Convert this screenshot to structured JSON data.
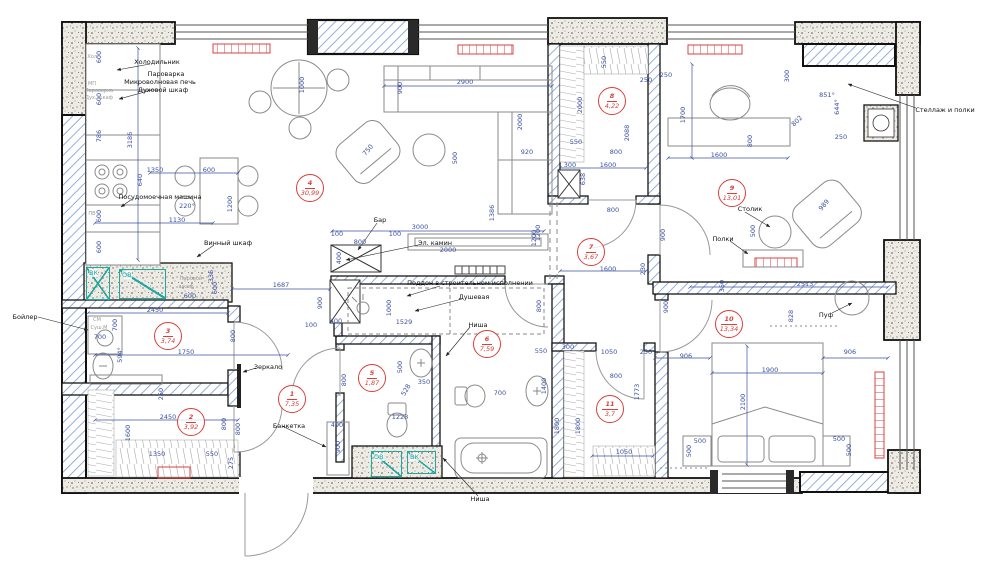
{
  "colors": {
    "dimension": "#3a50a0",
    "room_badge": "#d8403b",
    "wall": "#111111",
    "hatch": "#88a6d6",
    "shaft": "#1fa7a0",
    "radiator": "#d94040",
    "annotation": "#111111"
  },
  "rooms": [
    {
      "number": "1",
      "area": "7,35",
      "x": 291,
      "y": 398
    },
    {
      "number": "2",
      "area": "3,92",
      "x": 190,
      "y": 421
    },
    {
      "number": "3",
      "area": "3,74",
      "x": 167,
      "y": 335
    },
    {
      "number": "4",
      "area": "30,99",
      "x": 309,
      "y": 187
    },
    {
      "number": "5",
      "area": "1,87",
      "x": 371,
      "y": 377
    },
    {
      "number": "6",
      "area": "7,59",
      "x": 486,
      "y": 343
    },
    {
      "number": "7",
      "area": "3,67",
      "x": 590,
      "y": 251
    },
    {
      "number": "8",
      "area": "4,22",
      "x": 611,
      "y": 100
    },
    {
      "number": "9",
      "area": "13,01",
      "x": 731,
      "y": 192
    },
    {
      "number": "10",
      "area": "13,34",
      "x": 728,
      "y": 323
    },
    {
      "number": "11",
      "area": "3,7",
      "x": 609,
      "y": 408
    }
  ],
  "annotations": [
    {
      "t": "Холодильник",
      "x": 157,
      "y": 62
    },
    {
      "t": "Пароварка",
      "x": 166,
      "y": 74
    },
    {
      "t": "Микроволновая печь",
      "x": 160,
      "y": 82
    },
    {
      "t": "Духовой шкаф",
      "x": 163,
      "y": 90
    },
    {
      "t": "Посудомоечная машина",
      "x": 160,
      "y": 197
    },
    {
      "t": "Винный шкаф",
      "x": 228,
      "y": 243
    },
    {
      "t": "Бар",
      "x": 380,
      "y": 220
    },
    {
      "t": "Эл. камин",
      "x": 435,
      "y": 243
    },
    {
      "t": "Поддон в строительном исполнении",
      "x": 470,
      "y": 283
    },
    {
      "t": "Душевая",
      "x": 474,
      "y": 297
    },
    {
      "t": "Ниша",
      "x": 478,
      "y": 325
    },
    {
      "t": "Зеркало",
      "x": 268,
      "y": 367
    },
    {
      "t": "Банкетка",
      "x": 289,
      "y": 426
    },
    {
      "t": "Бойлер",
      "x": 25,
      "y": 317
    },
    {
      "t": "Стеллаж и полки",
      "x": 945,
      "y": 110
    },
    {
      "t": "Столик",
      "x": 750,
      "y": 209
    },
    {
      "t": "Полки",
      "x": 723,
      "y": 239
    },
    {
      "t": "Пуф",
      "x": 826,
      "y": 315
    },
    {
      "t": "Ниша",
      "x": 480,
      "y": 499
    }
  ],
  "equipment_labels": [
    {
      "t": "Хол.",
      "x": 93,
      "y": 57
    },
    {
      "t": "МП",
      "x": 92,
      "y": 84
    },
    {
      "t": "Пароварка",
      "x": 99,
      "y": 91
    },
    {
      "t": "Дух. шкаф",
      "x": 99,
      "y": 98
    },
    {
      "t": "ПВ",
      "x": 92,
      "y": 214
    },
    {
      "t": "СМ",
      "x": 97,
      "y": 320
    },
    {
      "t": "Суш.М",
      "x": 99,
      "y": 328
    },
    {
      "t": "Паровой",
      "x": 191,
      "y": 279
    },
    {
      "t": "шкаф",
      "x": 186,
      "y": 287
    }
  ],
  "shafts": [
    {
      "label": "ВК",
      "x": 86,
      "y": 267,
      "w": 24,
      "h": 33,
      "cross": true
    },
    {
      "label": "ОВ",
      "x": 119,
      "y": 269,
      "w": 47,
      "h": 30,
      "cross": false
    },
    {
      "label": "ОВ",
      "x": 371,
      "y": 451,
      "w": 31,
      "h": 26,
      "cross": false
    },
    {
      "label": "ВК",
      "x": 407,
      "y": 451,
      "w": 29,
      "h": 23,
      "cross": false
    }
  ],
  "dimensions": [
    {
      "t": "600",
      "x": 99,
      "y": 57,
      "v": 1
    },
    {
      "t": "600",
      "x": 99,
      "y": 99,
      "v": 1
    },
    {
      "t": "786",
      "x": 99,
      "y": 136,
      "v": 1
    },
    {
      "t": "3186",
      "x": 130,
      "y": 140,
      "v": 1
    },
    {
      "t": "640",
      "x": 140,
      "y": 180,
      "v": 1
    },
    {
      "t": "600",
      "x": 99,
      "y": 216,
      "v": 1
    },
    {
      "t": "600",
      "x": 99,
      "y": 247,
      "v": 1
    },
    {
      "t": "1350",
      "x": 155,
      "y": 170
    },
    {
      "t": "600",
      "x": 209,
      "y": 170
    },
    {
      "t": "1200",
      "x": 230,
      "y": 204,
      "v": 1
    },
    {
      "t": "220°",
      "x": 187,
      "y": 206
    },
    {
      "t": "1130",
      "x": 177,
      "y": 220
    },
    {
      "t": "1000",
      "x": 302,
      "y": 85,
      "v": 1
    },
    {
      "t": "2900",
      "x": 465,
      "y": 82
    },
    {
      "t": "900",
      "x": 400,
      "y": 88,
      "v": 1
    },
    {
      "t": "2000",
      "x": 520,
      "y": 122,
      "v": 1
    },
    {
      "t": "920",
      "x": 527,
      "y": 152
    },
    {
      "t": "500",
      "x": 455,
      "y": 158,
      "v": 1
    },
    {
      "t": "750",
      "x": 368,
      "y": 150,
      "r": -50
    },
    {
      "t": "3000",
      "x": 420,
      "y": 227
    },
    {
      "t": "100",
      "x": 337,
      "y": 234
    },
    {
      "t": "800",
      "x": 360,
      "y": 242
    },
    {
      "t": "100",
      "x": 395,
      "y": 234
    },
    {
      "t": "400",
      "x": 339,
      "y": 258,
      "v": 1
    },
    {
      "t": "2000",
      "x": 448,
      "y": 250
    },
    {
      "t": "1386",
      "x": 492,
      "y": 213,
      "v": 1
    },
    {
      "t": "1200",
      "x": 538,
      "y": 233,
      "v": 1
    },
    {
      "t": "900",
      "x": 320,
      "y": 303,
      "v": 1
    },
    {
      "t": "400",
      "x": 336,
      "y": 321
    },
    {
      "t": "100",
      "x": 311,
      "y": 325
    },
    {
      "t": "1000",
      "x": 389,
      "y": 308,
      "v": 1
    },
    {
      "t": "1529",
      "x": 404,
      "y": 322
    },
    {
      "t": "1687",
      "x": 281,
      "y": 285
    },
    {
      "t": "336",
      "x": 211,
      "y": 276,
      "v": 1
    },
    {
      "t": "600",
      "x": 215,
      "y": 288,
      "v": 1
    },
    {
      "t": "600",
      "x": 190,
      "y": 296
    },
    {
      "t": "2450",
      "x": 155,
      "y": 310
    },
    {
      "t": "700",
      "x": 115,
      "y": 325,
      "v": 1
    },
    {
      "t": "700",
      "x": 100,
      "y": 337
    },
    {
      "t": "800",
      "x": 233,
      "y": 336,
      "v": 1
    },
    {
      "t": "1750",
      "x": 186,
      "y": 352
    },
    {
      "t": "594°",
      "x": 120,
      "y": 355,
      "v": 1
    },
    {
      "t": "250",
      "x": 161,
      "y": 394,
      "v": 1
    },
    {
      "t": "2450",
      "x": 168,
      "y": 417
    },
    {
      "t": "800",
      "x": 224,
      "y": 424,
      "v": 1
    },
    {
      "t": "1600",
      "x": 128,
      "y": 433,
      "v": 1
    },
    {
      "t": "1350",
      "x": 157,
      "y": 454
    },
    {
      "t": "550",
      "x": 212,
      "y": 454
    },
    {
      "t": "800",
      "x": 238,
      "y": 429,
      "v": 1
    },
    {
      "t": "275",
      "x": 231,
      "y": 463,
      "v": 1
    },
    {
      "t": "400",
      "x": 337,
      "y": 425
    },
    {
      "t": "900",
      "x": 338,
      "y": 447,
      "v": 1
    },
    {
      "t": "800",
      "x": 344,
      "y": 380,
      "v": 1
    },
    {
      "t": "500",
      "x": 400,
      "y": 367,
      "v": 1
    },
    {
      "t": "350",
      "x": 424,
      "y": 382
    },
    {
      "t": "528",
      "x": 406,
      "y": 390,
      "r": -60
    },
    {
      "t": "1228",
      "x": 400,
      "y": 417
    },
    {
      "t": "550",
      "x": 541,
      "y": 351
    },
    {
      "t": "300",
      "x": 568,
      "y": 347
    },
    {
      "t": "700",
      "x": 500,
      "y": 393
    },
    {
      "t": "1400",
      "x": 544,
      "y": 386,
      "v": 1
    },
    {
      "t": "1800",
      "x": 557,
      "y": 426,
      "v": 1
    },
    {
      "t": "1600",
      "x": 608,
      "y": 269
    },
    {
      "t": "230",
      "x": 643,
      "y": 269,
      "v": 1
    },
    {
      "t": "800",
      "x": 613,
      "y": 210
    },
    {
      "t": "1200",
      "x": 534,
      "y": 238,
      "v": 1
    },
    {
      "t": "900",
      "x": 663,
      "y": 235,
      "v": 1
    },
    {
      "t": "900",
      "x": 666,
      "y": 307,
      "v": 1
    },
    {
      "t": "800",
      "x": 539,
      "y": 306,
      "v": 1
    },
    {
      "t": "550",
      "x": 604,
      "y": 62,
      "v": 1
    },
    {
      "t": "2000",
      "x": 580,
      "y": 105,
      "v": 1
    },
    {
      "t": "250",
      "x": 646,
      "y": 80
    },
    {
      "t": "250",
      "x": 666,
      "y": 75
    },
    {
      "t": "2088",
      "x": 627,
      "y": 133,
      "v": 1
    },
    {
      "t": "800",
      "x": 616,
      "y": 152
    },
    {
      "t": "1600",
      "x": 608,
      "y": 165
    },
    {
      "t": "638",
      "x": 583,
      "y": 179,
      "v": 1
    },
    {
      "t": "300",
      "x": 570,
      "y": 165
    },
    {
      "t": "550",
      "x": 576,
      "y": 142
    },
    {
      "t": "1700",
      "x": 683,
      "y": 115,
      "v": 1
    },
    {
      "t": "1600",
      "x": 719,
      "y": 155
    },
    {
      "t": "800",
      "x": 750,
      "y": 141,
      "v": 1
    },
    {
      "t": "500",
      "x": 753,
      "y": 231,
      "v": 1
    },
    {
      "t": "350",
      "x": 722,
      "y": 286,
      "v": 1
    },
    {
      "t": "2513",
      "x": 805,
      "y": 284
    },
    {
      "t": "828",
      "x": 791,
      "y": 316,
      "v": 1
    },
    {
      "t": "906",
      "x": 686,
      "y": 356
    },
    {
      "t": "906",
      "x": 850,
      "y": 352
    },
    {
      "t": "1900",
      "x": 770,
      "y": 370
    },
    {
      "t": "2100",
      "x": 743,
      "y": 402,
      "v": 1
    },
    {
      "t": "500",
      "x": 700,
      "y": 441
    },
    {
      "t": "500",
      "x": 689,
      "y": 451,
      "v": 1
    },
    {
      "t": "500",
      "x": 839,
      "y": 439
    },
    {
      "t": "500",
      "x": 849,
      "y": 450,
      "v": 1
    },
    {
      "t": "1050",
      "x": 609,
      "y": 352
    },
    {
      "t": "250",
      "x": 646,
      "y": 352
    },
    {
      "t": "800",
      "x": 616,
      "y": 376
    },
    {
      "t": "1773",
      "x": 637,
      "y": 392,
      "v": 1
    },
    {
      "t": "1800",
      "x": 578,
      "y": 426,
      "v": 1
    },
    {
      "t": "1050",
      "x": 624,
      "y": 452
    },
    {
      "t": "300",
      "x": 787,
      "y": 76,
      "v": 1
    },
    {
      "t": "851°",
      "x": 827,
      "y": 95
    },
    {
      "t": "644°",
      "x": 837,
      "y": 107,
      "v": 1
    },
    {
      "t": "802",
      "x": 797,
      "y": 121,
      "r": -45
    },
    {
      "t": "250",
      "x": 841,
      "y": 137
    },
    {
      "t": "989",
      "x": 824,
      "y": 205,
      "r": -50
    }
  ]
}
